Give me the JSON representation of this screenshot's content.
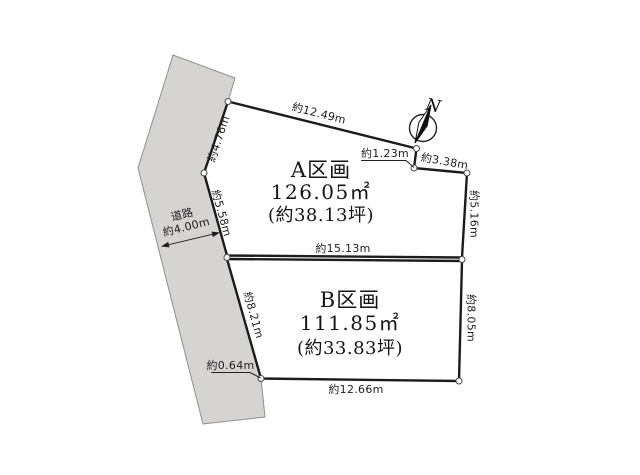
{
  "colors": {
    "plot_gradient_start": "#e4f0d4",
    "plot_gradient_end": "#a3d08c",
    "road_fill": "#d6d3d3",
    "road_outline": "#8f8f8f",
    "boundary": "#1c1c1c"
  },
  "road": {
    "name": "道路",
    "width": "約4.00m"
  },
  "compass": {
    "north": "N"
  },
  "plots": {
    "a": {
      "name": "A区画",
      "area": "126.05㎡",
      "tsubo": "(約38.13坪)"
    },
    "b": {
      "name": "B区画",
      "area": "111.85㎡",
      "tsubo": "(約33.83坪)"
    }
  },
  "measurements": {
    "a_top": "約12.49m",
    "a_upper_left": "約4.76m",
    "a_lower_left": "約5.58m",
    "notch_step": "約1.23m",
    "notch_top": "約3.38m",
    "a_right": "約5.16m",
    "divider": "約15.13m",
    "b_left": "約8.21m",
    "b_right": "約8.05m",
    "b_bottom": "約12.66m",
    "b_corner_offset": "約0.64m"
  }
}
